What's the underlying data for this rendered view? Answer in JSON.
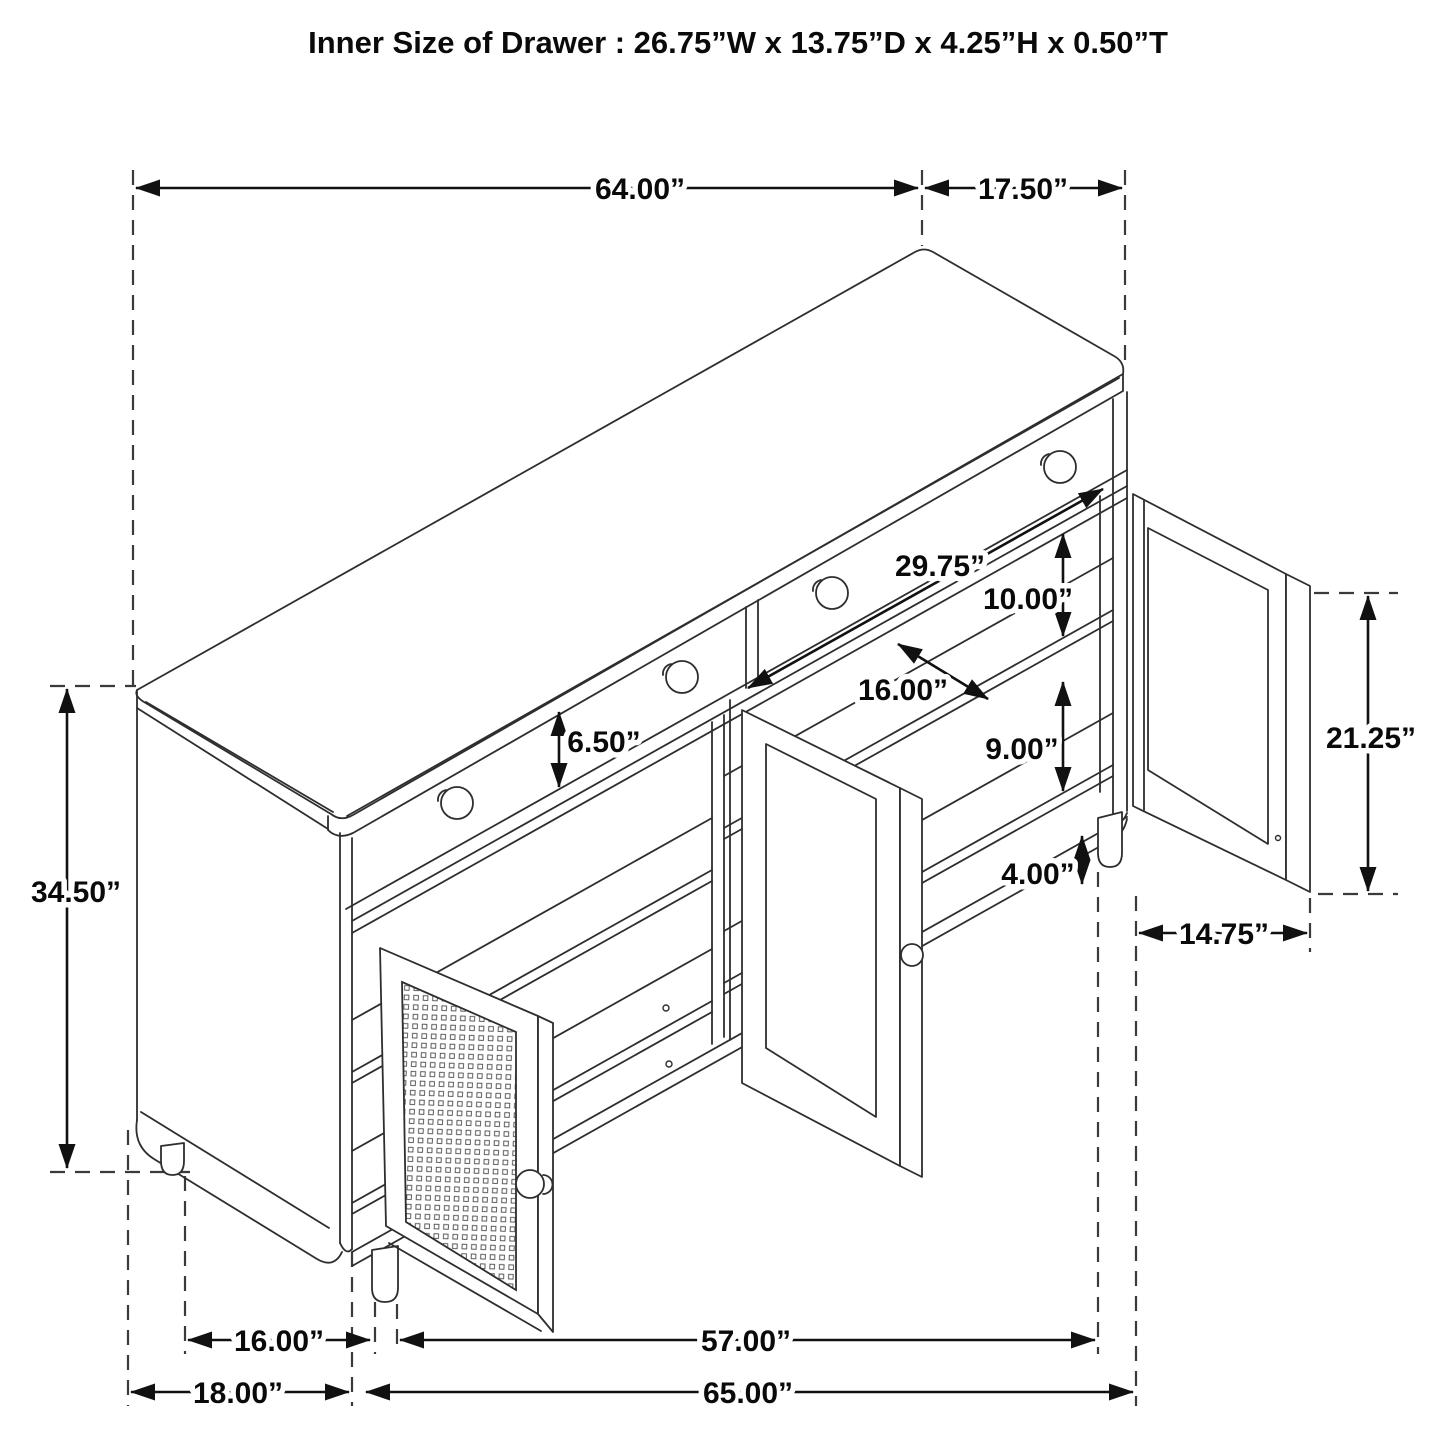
{
  "title": "Inner Size of Drawer  : 26.75”W x 13.75”D x 4.25”H x 0.50”T",
  "dimensions": {
    "top_width": "64.00”",
    "top_depth": "17.50”",
    "interior_width": "29.75”",
    "shelf_gap_upper": "10.00”",
    "shelf_depth": "16.00”",
    "drawer_front_height": "6.50”",
    "shelf_gap_lower": "9.00”",
    "leg_height": "4.00”",
    "overall_height": "34.50”",
    "door_height": "21.25”",
    "door_width": "14.75”",
    "leg_span_depth": "16.00”",
    "leg_span_width": "57.00”",
    "base_depth": "18.00”",
    "base_width": "65.00”"
  }
}
